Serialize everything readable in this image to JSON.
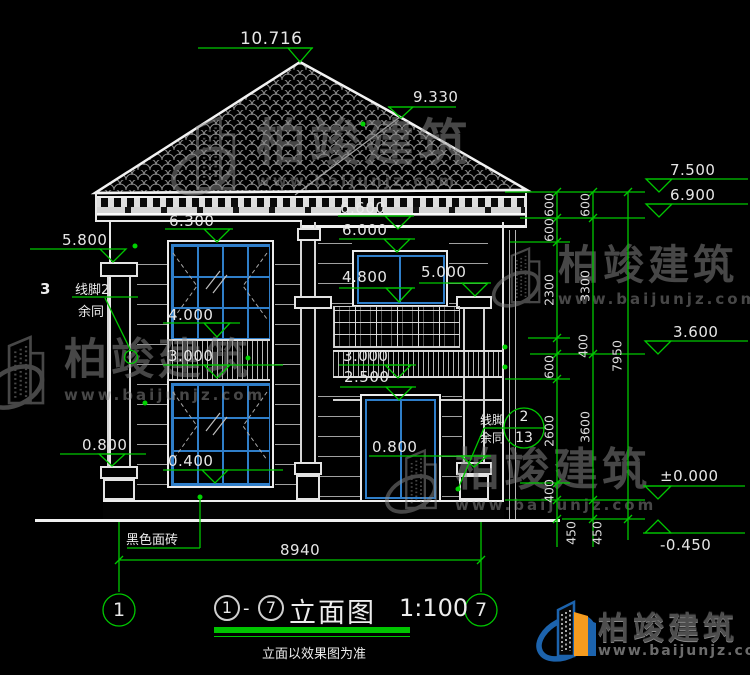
{
  "drawing": {
    "title_circle_left": "1",
    "title_dash": "-",
    "title_circle_right": "7",
    "title_name": "立面图",
    "title_scale": "1:100",
    "title_note": "立面以效果图为准",
    "grid_left": "1",
    "grid_right": "7"
  },
  "elevations": {
    "peak": "10.716",
    "right_ridge": "9.330",
    "parapet_top": "7.500",
    "eave_under": "6.900",
    "eave_bottom": "6.600",
    "left_window_top": "6.300",
    "upper_window_top": "6.000",
    "left_capital": "5.800",
    "balcony_post": "5.000",
    "upper_sill": "4.800",
    "mid_band_top": "4.000",
    "level2": "3.600",
    "mid_band_bottom_left": "3.000",
    "mid_band_bottom_center": "3.000",
    "balcony_slab": "2.500",
    "left_base": "0.800",
    "center_base": "0.800",
    "left_window_bottom": "0.400",
    "level0": "±0.000",
    "ground": "-0.450"
  },
  "dims": {
    "inner": [
      "600",
      "600",
      "2300",
      "400",
      "600",
      "2600",
      "400",
      "450"
    ],
    "middle": [
      "600",
      "3300",
      "3600",
      "450"
    ],
    "outer": [
      "7950"
    ],
    "width": "8940"
  },
  "callouts": {
    "left_index": "3",
    "left_line1": "线脚2",
    "left_line2": "余同",
    "right_line1": "线脚",
    "right_line2": "余同",
    "detail_num": "2",
    "detail_sheet": "13",
    "material": "黑色面砖"
  },
  "watermark": {
    "name": "柏竣建筑",
    "url": "www.baijunjz.com"
  },
  "logo": {
    "name": "柏竣建筑",
    "url": "www.baijunjz.com"
  },
  "colors": {
    "dimension_green": "#00c800",
    "window_blue": "#2f7ec9",
    "line_white": "#e6e6e6",
    "logo_blue": "#1c63ad",
    "logo_orange": "#f49b1f"
  }
}
